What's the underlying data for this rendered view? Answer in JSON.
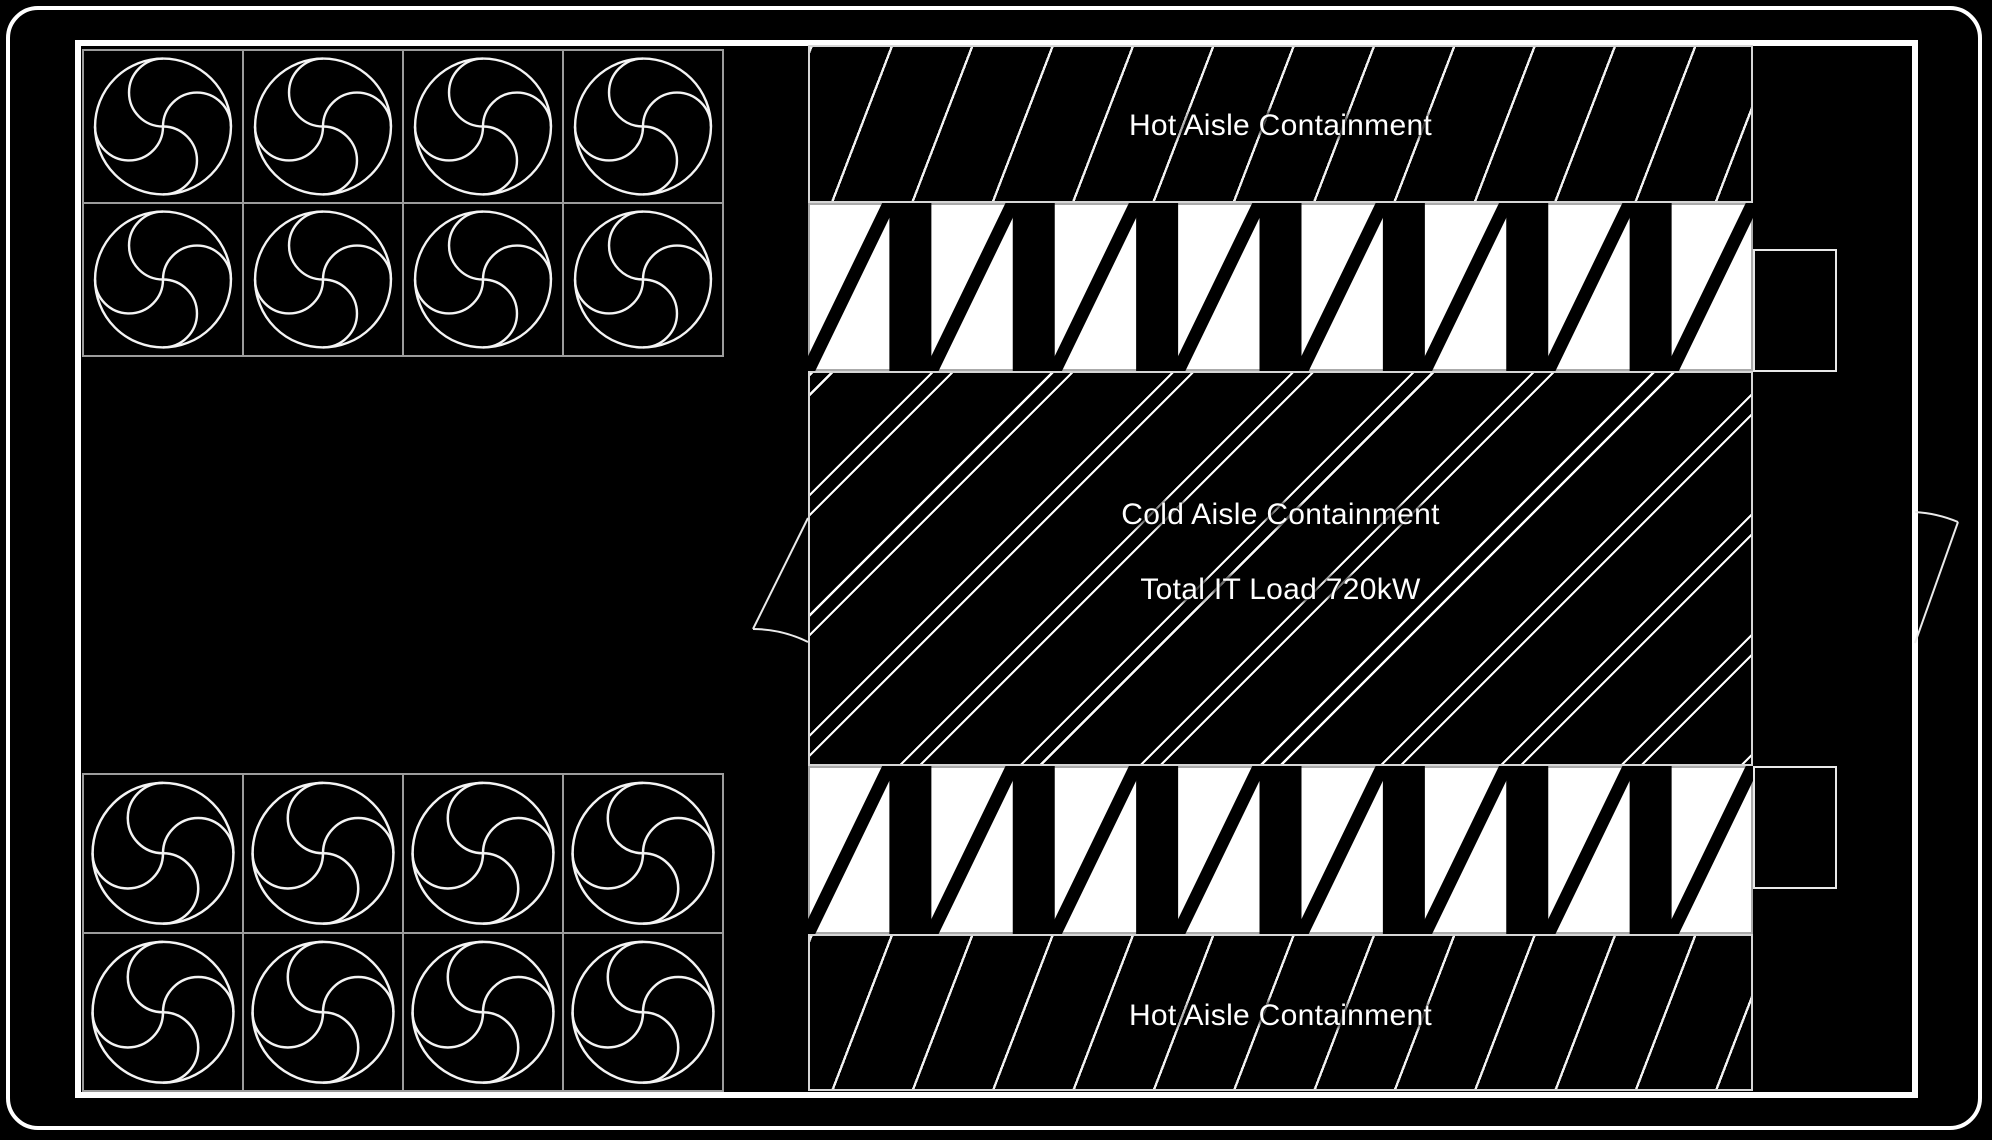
{
  "labels": {
    "hot_aisle_top": "Hot Aisle Containment",
    "cold_aisle": "Cold Aisle Containment",
    "total_it_load": "Total IT Load 720kW",
    "hot_aisle_bottom": "Hot Aisle Containment"
  },
  "total_it_load_kw": 720,
  "fan_blocks": [
    {
      "name": "fan-array-top-left",
      "columns": 4,
      "rows": 2
    },
    {
      "name": "fan-array-bottom-left",
      "columns": 4,
      "rows": 2
    }
  ],
  "rack_rows": [
    {
      "name": "rack-row-top",
      "units": 8
    },
    {
      "name": "rack-row-bottom",
      "units": 8
    }
  ],
  "doors": [
    {
      "name": "cold-aisle-left-door"
    },
    {
      "name": "right-wall-exterior-door"
    }
  ],
  "colors": {
    "background": "#000000",
    "line": "#ffffff",
    "grid_line": "#9c9c9c",
    "rack_fill": "#ffffff",
    "rack_bar": "#000000",
    "hatch_line": "#ffffff"
  }
}
